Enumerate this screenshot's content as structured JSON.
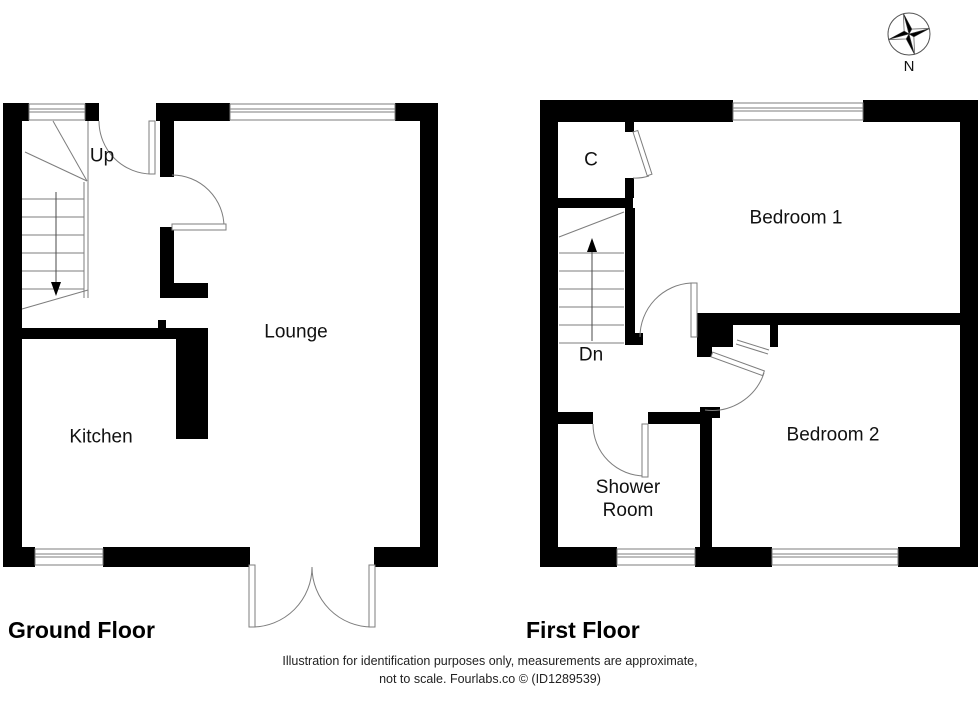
{
  "compass": {
    "label": "N"
  },
  "ground_floor": {
    "title": "Ground Floor",
    "stair_label": "Up",
    "rooms": {
      "lounge": "Lounge",
      "kitchen": "Kitchen"
    }
  },
  "first_floor": {
    "title": "First Floor",
    "stair_label": "Dn",
    "rooms": {
      "cupboard": "C",
      "bedroom1": "Bedroom 1",
      "bedroom2": "Bedroom 2",
      "shower_room": "Shower Room"
    }
  },
  "footer": {
    "line1": "Illustration for identification purposes only, measurements are approximate,",
    "line2": "not to scale. Fourlabs.co © (ID1289539)"
  },
  "colors": {
    "wall": "#000000",
    "line": "#7d7d7d",
    "text": "#111111"
  }
}
